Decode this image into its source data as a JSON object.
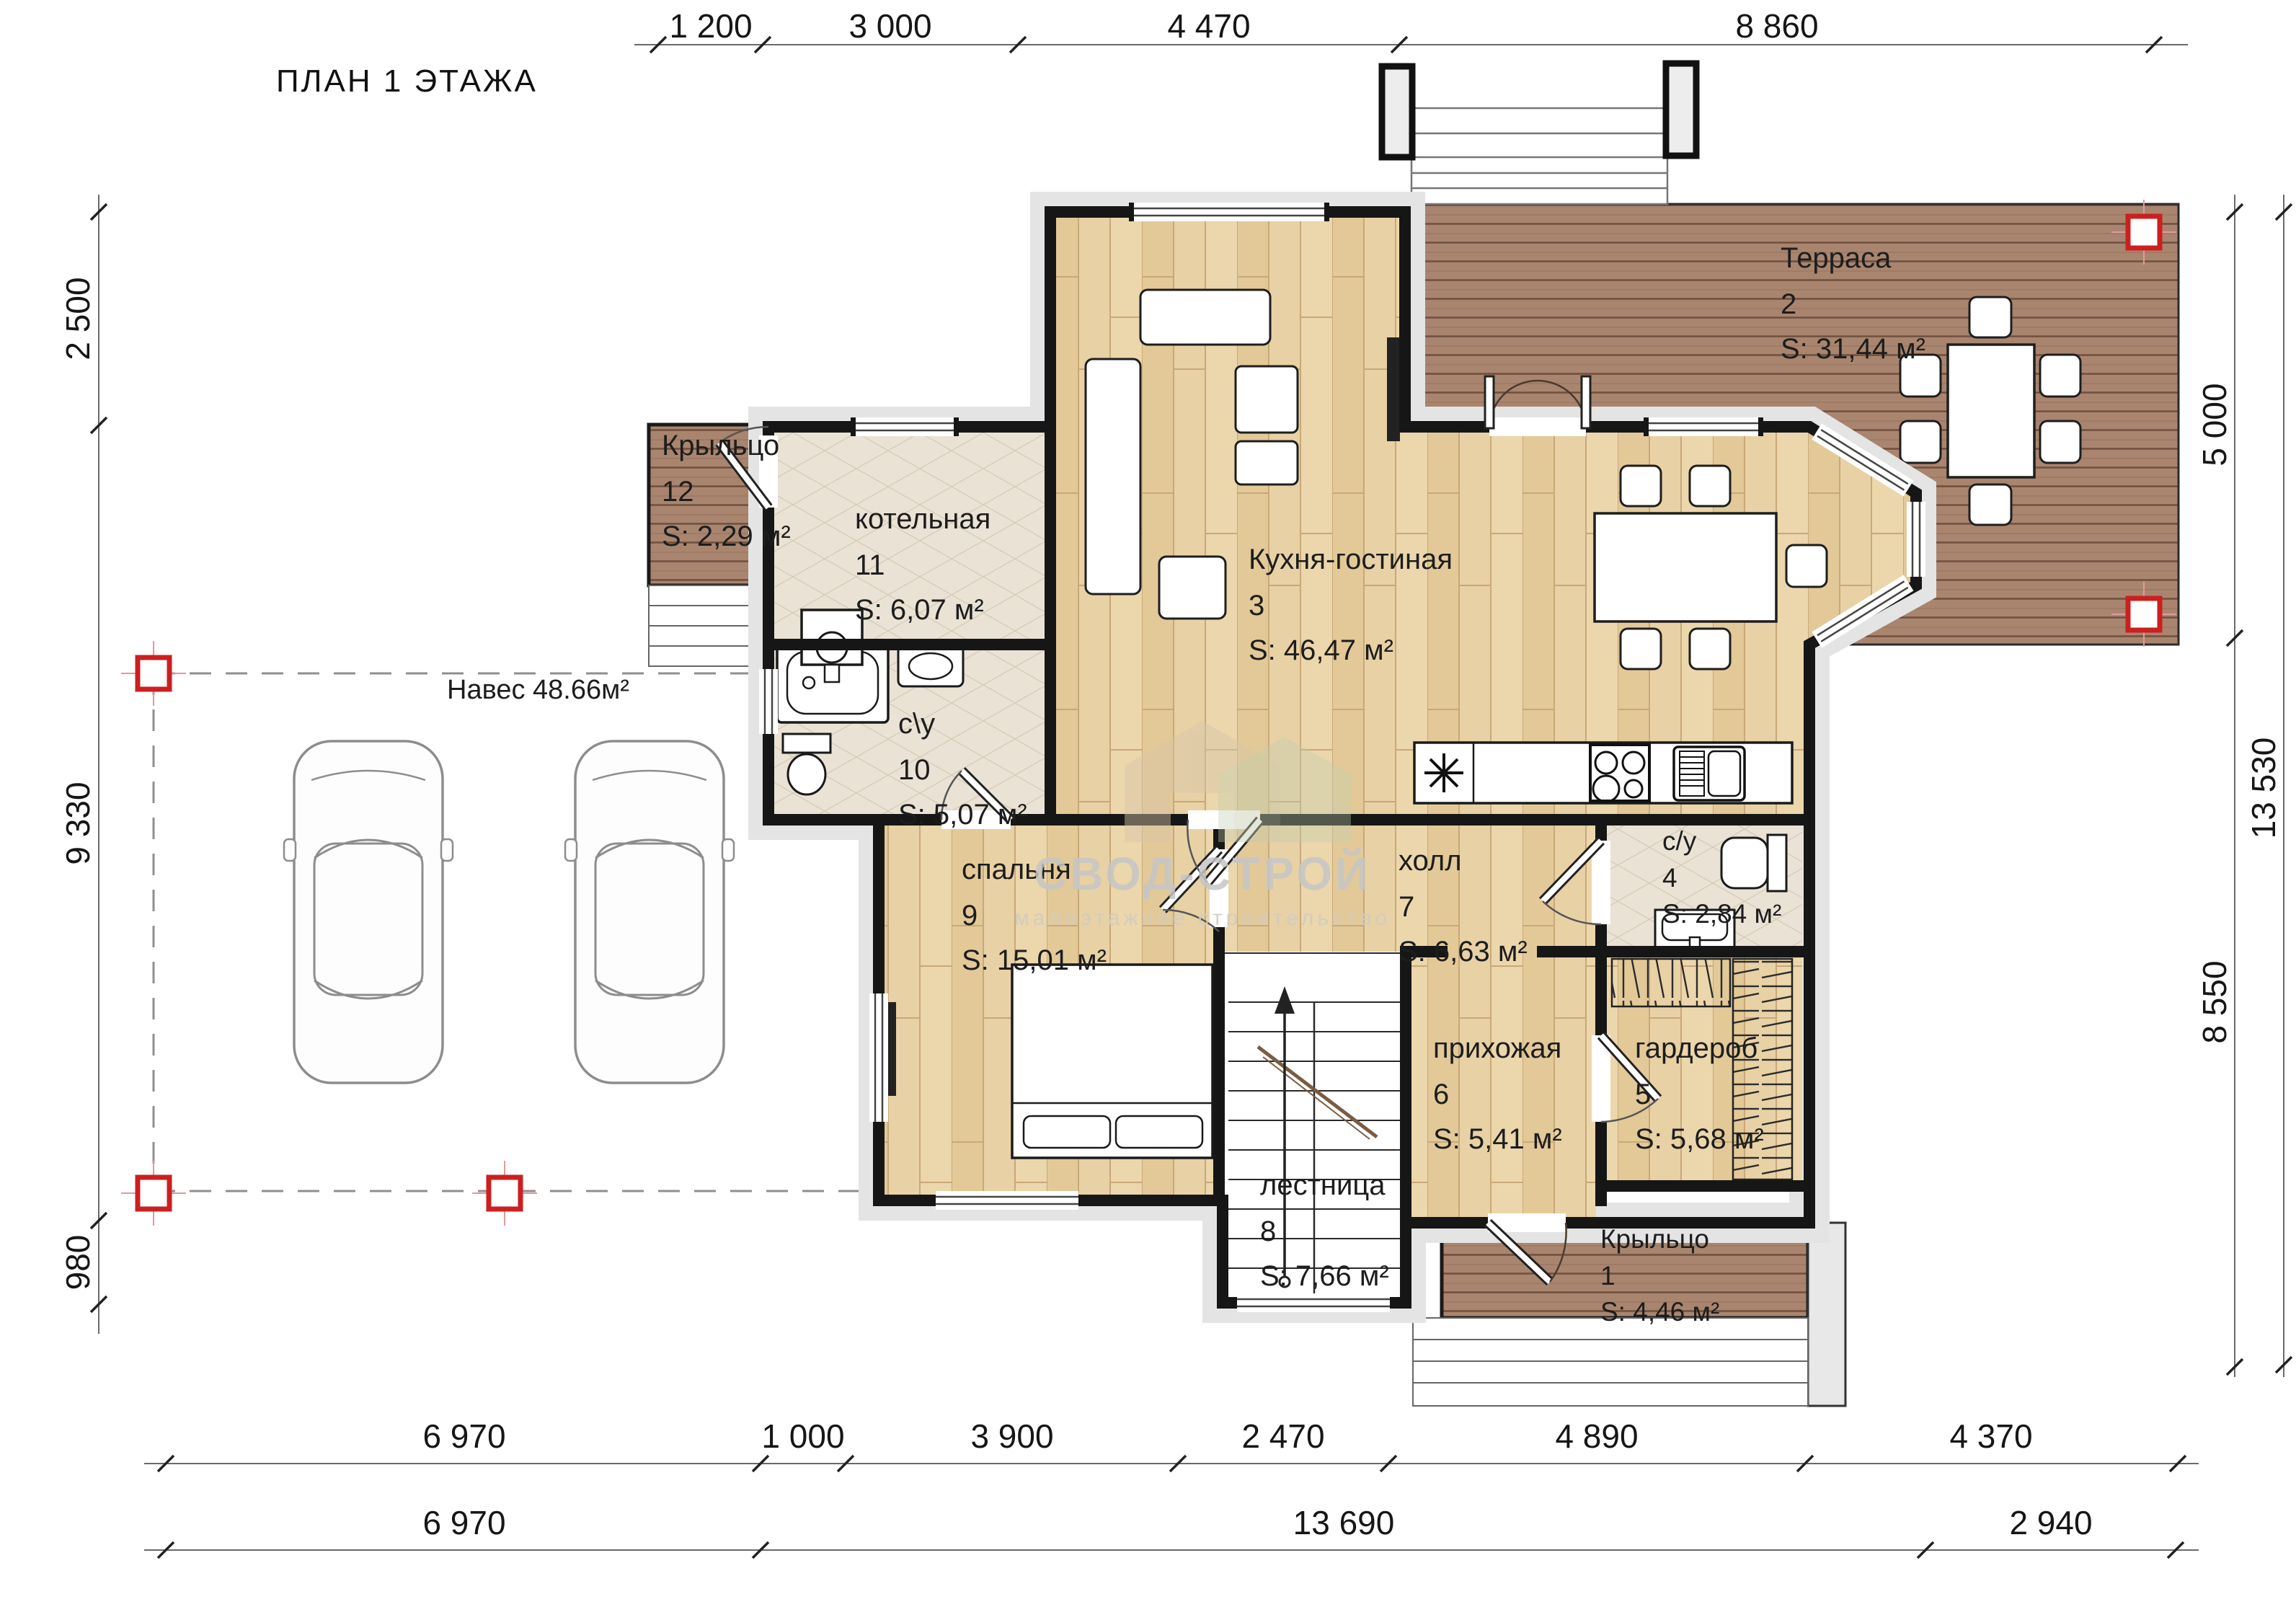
{
  "title": "ПЛАН 1 ЭТАЖА",
  "watermark": {
    "brand": "СВОД-СТРОЙ",
    "tagline": "малоэтажное строительство"
  },
  "carport": {
    "label": "Навес 48.66м²"
  },
  "dimensions": {
    "top": [
      "1 200",
      "3 000",
      "4 470",
      "8 860"
    ],
    "left": [
      "2 500",
      "9 330",
      "980"
    ],
    "right_inner": [
      "5 000",
      "8 550"
    ],
    "right_outer": [
      "13 530"
    ],
    "bottom_row1": [
      "6 970",
      "1 000",
      "3 900",
      "2 470",
      "4 890",
      "4 370"
    ],
    "bottom_row2": [
      "6 970",
      "13 690",
      "2 940"
    ]
  },
  "rooms": {
    "terrace": {
      "name": "Терраса",
      "num": "2",
      "area": "S: 31,44 м²"
    },
    "porch12": {
      "name": "Крыльцо",
      "num": "12",
      "area": "S: 2,29 м²"
    },
    "boiler": {
      "name": "котельная",
      "num": "11",
      "area": "S: 6,07 м²"
    },
    "kitchen": {
      "name": "Кухня-гостиная",
      "num": "3",
      "area": "S: 46,47 м²"
    },
    "bath10": {
      "name": "с\\у",
      "num": "10",
      "area": "S: 5,07 м²"
    },
    "bedroom": {
      "name": "спальня",
      "num": "9",
      "area": "S: 15,01 м²"
    },
    "hall": {
      "name": "холл",
      "num": "7",
      "area": "S: 6,63 м²"
    },
    "bath4": {
      "name": "с/у",
      "num": "4",
      "area": "S: 2,84 м²"
    },
    "entry": {
      "name": "прихожая",
      "num": "6",
      "area": "S: 5,41 м²"
    },
    "wardrobe": {
      "name": "гардероб",
      "num": "5",
      "area": "S: 5,68 м²"
    },
    "stairs": {
      "name": "лестница",
      "num": "8",
      "area": "S: 7,66 м²"
    },
    "porch1": {
      "name": "Крыльцо",
      "num": "1",
      "area": "S: 4,46 м²"
    }
  },
  "colors": {
    "deck_wood": "#a9856f",
    "light_wood": "#e8d1a5",
    "tile": "#eae3d5",
    "wall": "#161616",
    "column_marker_red": "#cc1f1f"
  }
}
